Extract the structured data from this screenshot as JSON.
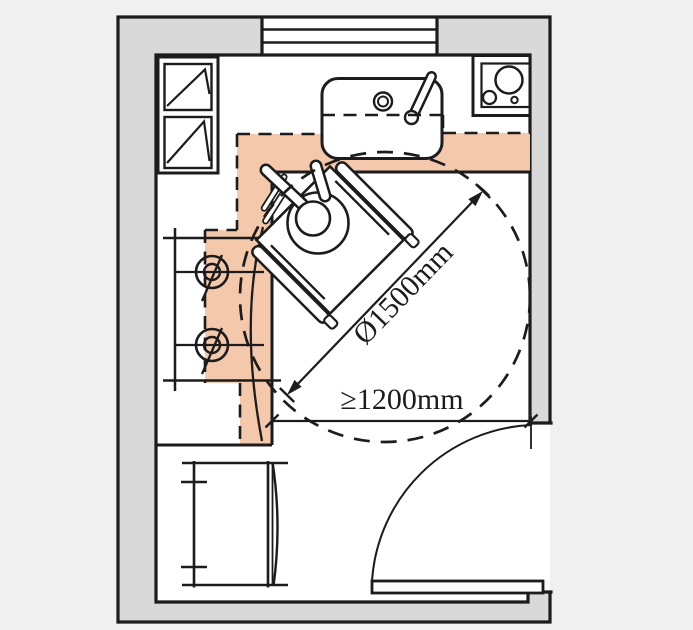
{
  "diagram": {
    "type": "accessible-kitchen-floor-plan",
    "annotations": {
      "turning_circle_label": "Ø1500mm",
      "door_clearance_label": "≥1200mm"
    },
    "measurements": {
      "turning_circle_diameter_mm": 1500,
      "door_clearance_min_mm": 1200
    },
    "fixtures": [
      "wall-cabinet",
      "kitchen-sink",
      "faucet",
      "corner-cooktop",
      "two-burner-hob-counter",
      "dining-table",
      "wheelchair-user",
      "turning-circle",
      "entry-door"
    ],
    "colors": {
      "reach_zone": "#f4c8ab",
      "wall_fill": "#d9d9d9",
      "line": "#1c1c1c",
      "background": "#f0f0f0",
      "floor": "#ffffff"
    }
  }
}
